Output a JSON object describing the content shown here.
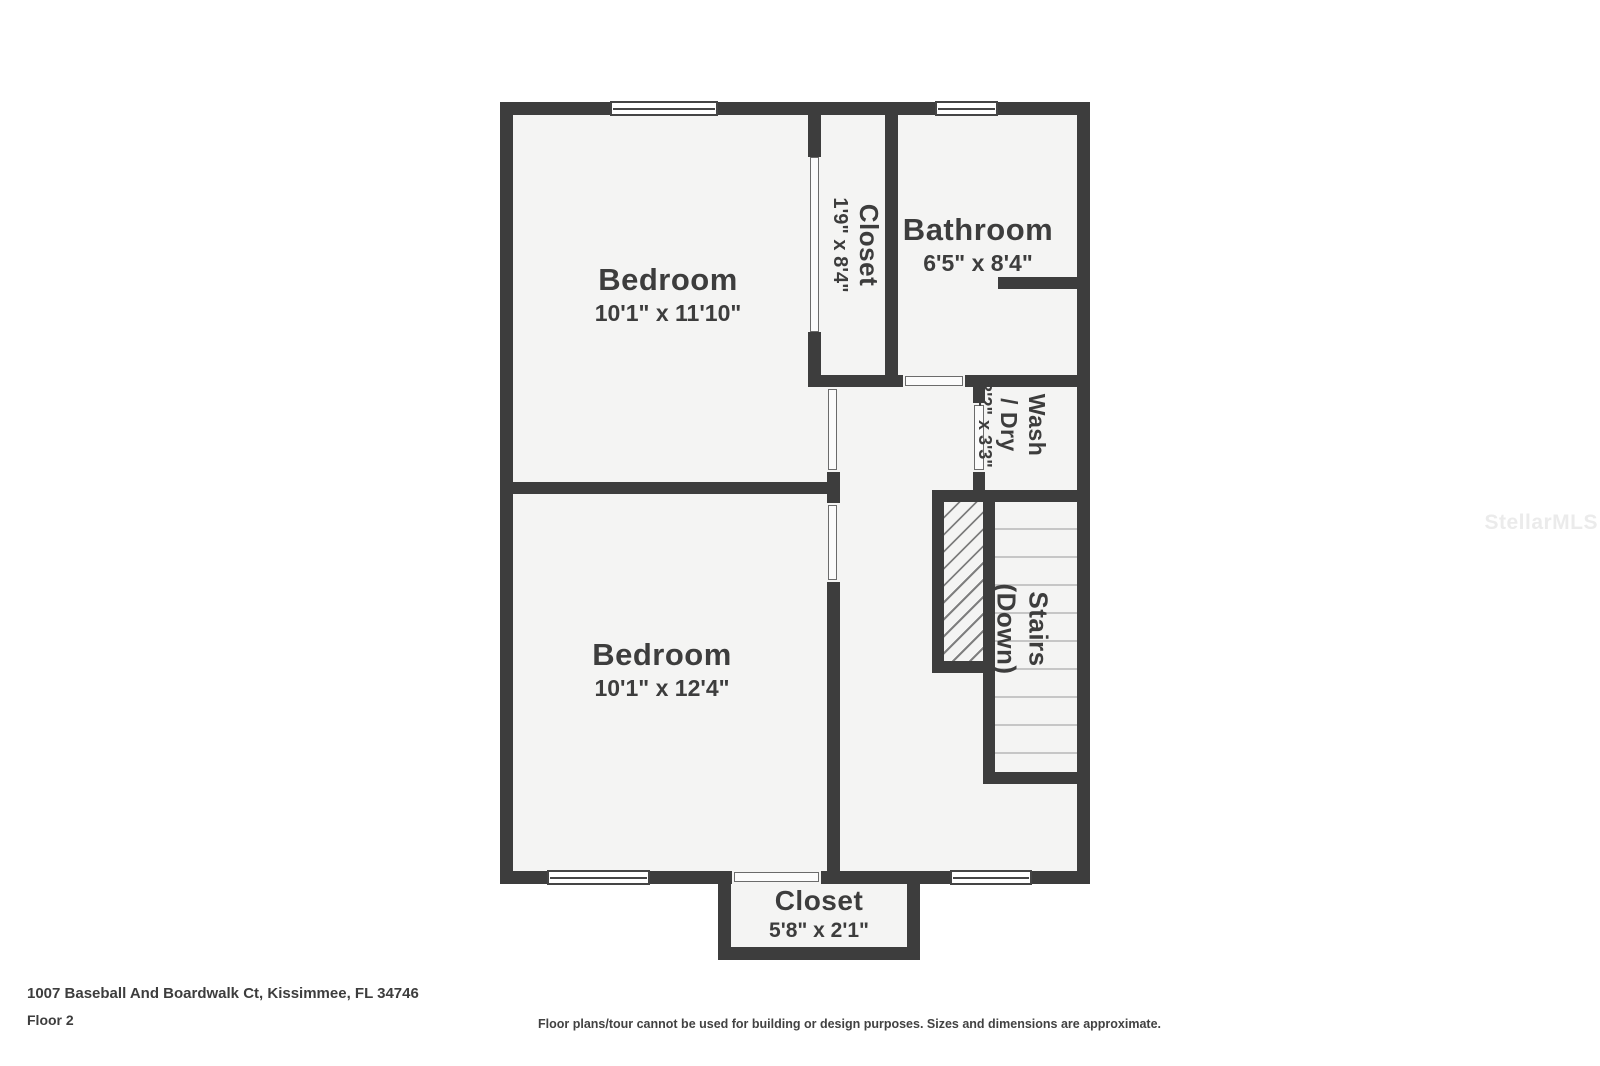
{
  "colors": {
    "wall": "#3d3d3d",
    "room_fill": "#f4f4f3",
    "label_text": "#3d3d3d",
    "step_line": "#c6c6c6",
    "watermark": "#ebebeb"
  },
  "watermark": {
    "text": "StellarMLS"
  },
  "footer": {
    "address": "1007 Baseball And Boardwalk Ct, Kissimmee, FL 34746",
    "floor_label": "Floor 2",
    "disclaimer": "Floor plans/tour cannot be used for building or design purposes. Sizes and dimensions are approximate."
  },
  "rooms": [
    {
      "id": "bedroom-top",
      "name": "Bedroom",
      "dims": "10'1\" x 11'10\""
    },
    {
      "id": "closet-top",
      "name": "Closet",
      "dims": "1'9\" x 8'4\""
    },
    {
      "id": "bathroom",
      "name": "Bathroom",
      "dims": "6'5\" x 8'4\""
    },
    {
      "id": "wash-dry",
      "name": "Wash",
      "name2": "/ Dry",
      "dims": "3'2\" x 3'3\""
    },
    {
      "id": "stairs",
      "name": "Stairs",
      "name2": "(Down)"
    },
    {
      "id": "bedroom-bottom",
      "name": "Bedroom",
      "dims": "10'1\" x 12'4\""
    },
    {
      "id": "closet-bottom",
      "name": "Closet",
      "dims": "5'8\" x 2'1\""
    }
  ]
}
